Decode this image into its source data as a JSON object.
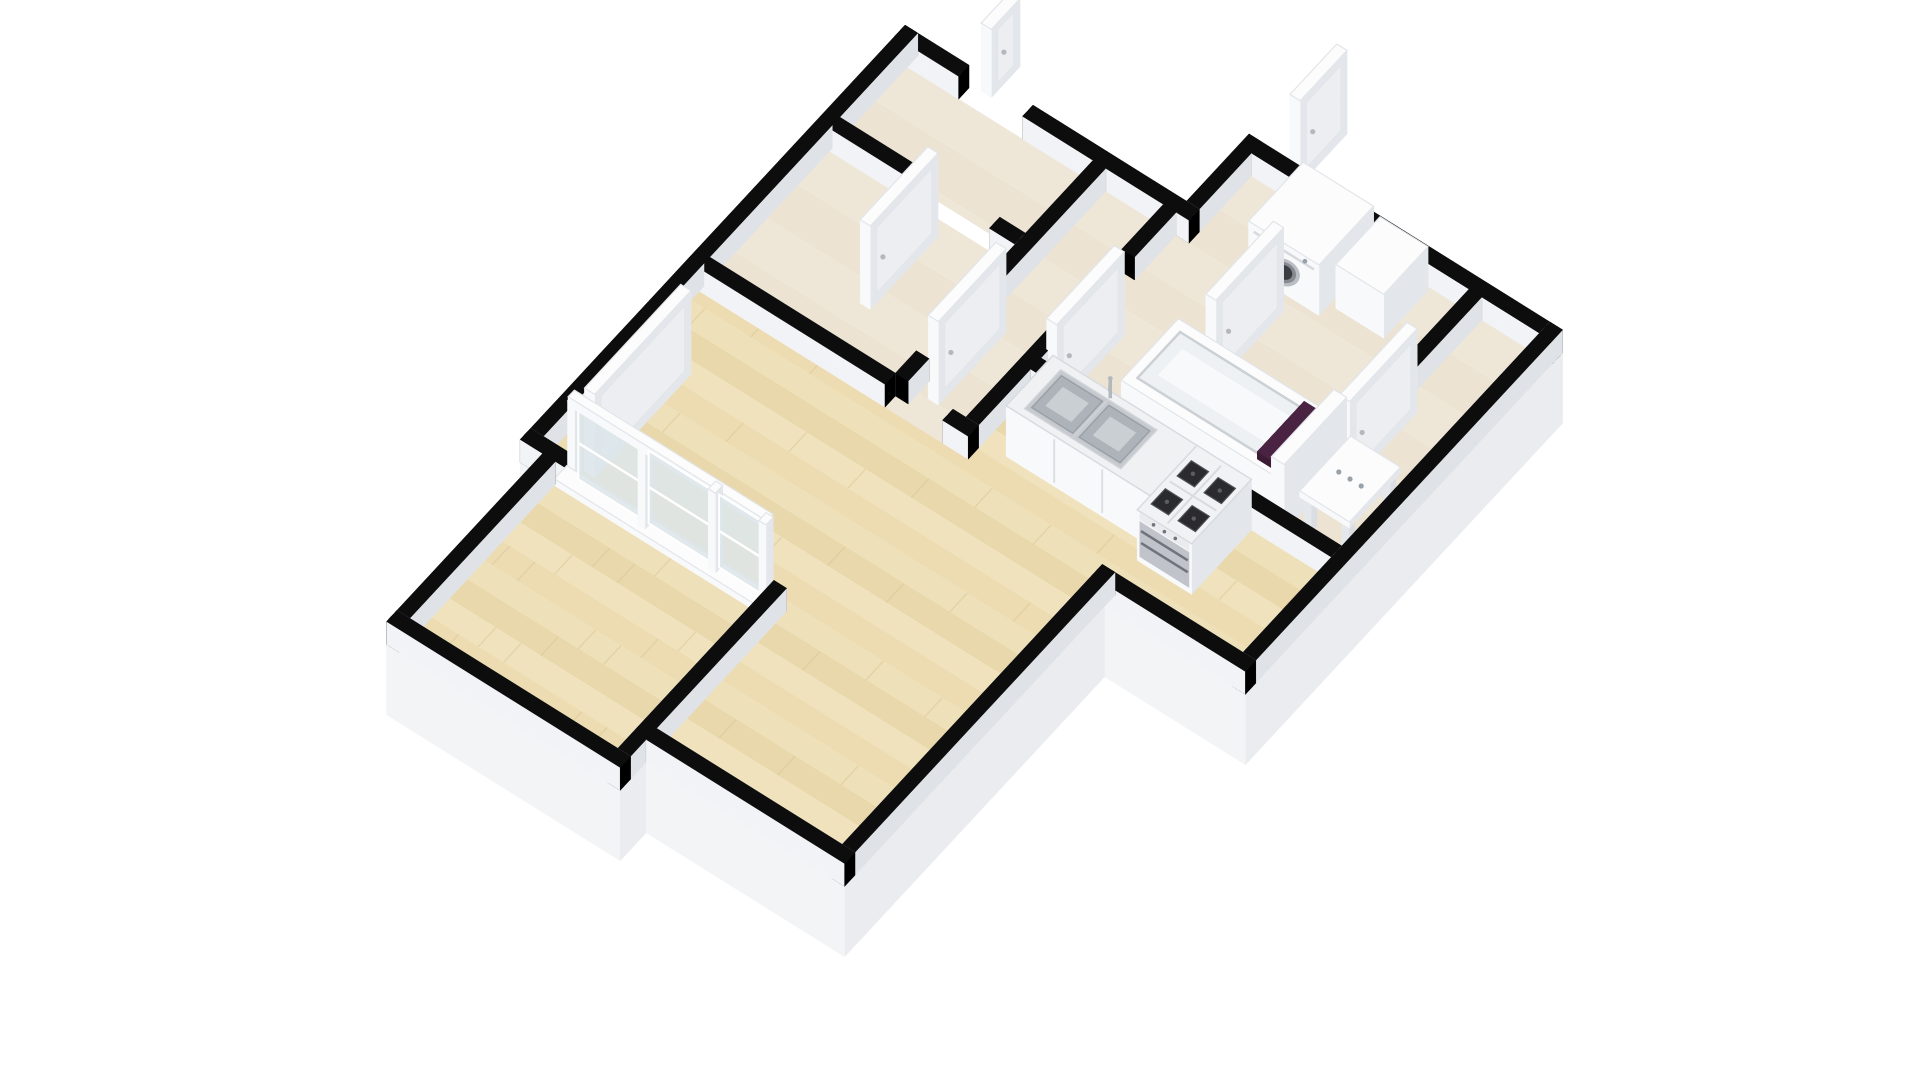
{
  "meta": {
    "description": "3D isometric floor plan rendering of a one-bedroom apartment: large living room with light parquet floor, open kitchen with double sink counter and gas stove, hallway with open white doors, bathroom with washing machine and bathtub with purple towel, separate toilet with washbasin console, and a long balcony room behind a glazed sliding-door wall",
    "canvas_width": 1920,
    "canvas_height": 1080,
    "background": "#ffffff"
  },
  "rooms": [
    {
      "name": "living-room",
      "floor": "parquet"
    },
    {
      "name": "kitchen",
      "floor": "parquet"
    },
    {
      "name": "hallway",
      "floor": "tile"
    },
    {
      "name": "entry",
      "floor": "tile"
    },
    {
      "name": "storage",
      "floor": "tile"
    },
    {
      "name": "bathroom",
      "floor": "tile"
    },
    {
      "name": "toilet",
      "floor": "tile"
    },
    {
      "name": "balcony",
      "floor": "parquet"
    }
  ],
  "projection": {
    "origin": [
      905,
      48
    ],
    "u": [
      640,
      400
    ],
    "v": [
      -520,
      560
    ],
    "z_scale": 440
  },
  "palette": {
    "background": "#ffffff",
    "wall_top": "#0d0d0d",
    "wall_cap": "#000000",
    "wall_side_sw": "#f2f3f6",
    "wall_side_ne": "#e6e9ed",
    "wall_side_se": "#dfe3e8",
    "wall_side_nw": "#edeff2",
    "slab_side_light": "#f3f4f6",
    "slab_side_dark": "#eaecef",
    "slab_top": "#ffffff",
    "wood_base": "#ecdbb0",
    "wood_bands": [
      "#f1e3bf",
      "#e8d5a7",
      "#f4e8c8",
      "#eedcb2"
    ],
    "wood_seam": "#d9c795",
    "tile_base": "#ece3d3",
    "tile_band": "#f3ecdf",
    "white_top": "#fcfcfd",
    "white_edge": "#e2e5e9",
    "white_py": "#f8f9fb",
    "white_ny": "#e7eaed",
    "white_px": "#e3e6ea",
    "white_nx": "#eef0f3",
    "glass": "#dce5ea",
    "steel": "#c0c4ca",
    "steel_dark": "#6f747c",
    "burner": "#2b2b2f",
    "burner_rim": "#4e5156",
    "grid_line": "#d9dbdf",
    "towel": "#4a2342",
    "towel_dark": "#3c1c35",
    "sink_rim": "#c6cacf",
    "sink_well": "#aeb3ba",
    "sink_inner": "#cdd1d6",
    "chrome": "#b3b8be",
    "washer_ring": "#b9bec5",
    "washer_mid": "#878b91",
    "washer_glass": "#3a3d42",
    "dot": "#9aa2a9"
  },
  "geometry": {
    "wall_height": 0.052,
    "slab_depth": 0.16,
    "slab_poly": [
      [
        0,
        0
      ],
      [
        0.44,
        0
      ],
      [
        0.44,
        -0.12
      ],
      [
        0.93,
        -0.12
      ],
      [
        0.93,
        0.49
      ],
      [
        0.71,
        0.49
      ],
      [
        0.71,
        0.99
      ],
      [
        0.4,
        0.99
      ],
      [
        0.4,
        1.04
      ],
      [
        0.035,
        1.04
      ],
      [
        0.035,
        0.74
      ],
      [
        0,
        0.74
      ]
    ],
    "floors": [
      {
        "name": "floor-living-kitchen",
        "type": "wood",
        "poly": [
          [
            0.02,
            0.42
          ],
          [
            0.44,
            0.42
          ],
          [
            0.44,
            0.3
          ],
          [
            0.91,
            0.3
          ],
          [
            0.91,
            0.47
          ],
          [
            0.69,
            0.47
          ],
          [
            0.69,
            0.97
          ],
          [
            0.4,
            0.97
          ],
          [
            0.4,
            0.72
          ],
          [
            0.02,
            0.72
          ]
        ]
      },
      {
        "name": "floor-balcony",
        "type": "wood",
        "poly": [
          [
            0.055,
            0.74
          ],
          [
            0.38,
            0.74
          ],
          [
            0.38,
            1.02
          ],
          [
            0.055,
            1.02
          ]
        ]
      },
      {
        "name": "floor-entry",
        "type": "tile",
        "poly": [
          [
            0.02,
            0.02
          ],
          [
            0.31,
            0.02
          ],
          [
            0.31,
            0.15
          ],
          [
            0.02,
            0.15
          ]
        ]
      },
      {
        "name": "floor-storage",
        "type": "tile",
        "poly": [
          [
            0.02,
            0.17
          ],
          [
            0.31,
            0.17
          ],
          [
            0.31,
            0.4
          ],
          [
            0.02,
            0.4
          ]
        ]
      },
      {
        "name": "floor-hallway",
        "type": "tile",
        "poly": [
          [
            0.31,
            0.02
          ],
          [
            0.44,
            0.02
          ],
          [
            0.44,
            0.42
          ],
          [
            0.31,
            0.42
          ]
        ]
      },
      {
        "name": "floor-bathroom",
        "type": "tile",
        "poly": [
          [
            0.44,
            -0.1
          ],
          [
            0.8,
            -0.1
          ],
          [
            0.8,
            0.3
          ],
          [
            0.44,
            0.3
          ]
        ]
      },
      {
        "name": "floor-toilet",
        "type": "tile",
        "poly": [
          [
            0.8,
            -0.1
          ],
          [
            0.91,
            -0.1
          ],
          [
            0.91,
            0.3
          ],
          [
            0.8,
            0.3
          ]
        ]
      }
    ],
    "plank_band": 0.034,
    "tile_band_step": 0.06,
    "walls": [
      {
        "name": "wall-outer-nw",
        "o": "v",
        "x": [
          0,
          0.02
        ],
        "y": [
          0,
          0.74
        ]
      },
      {
        "name": "wall-balcony-nw",
        "o": "v",
        "x": [
          0.035,
          0.055
        ],
        "y": [
          0.74,
          1.04
        ]
      },
      {
        "name": "wall-outer-ne-a",
        "o": "u",
        "x": [
          0,
          0.1
        ],
        "y": [
          0,
          0.02
        ]
      },
      {
        "name": "wall-outer-ne-b",
        "o": "u",
        "x": [
          0.2,
          0.46
        ],
        "y": [
          0,
          0.02
        ]
      },
      {
        "name": "wall-wing-step",
        "o": "v",
        "x": [
          0.44,
          0.46
        ],
        "y": [
          -0.12,
          0.02
        ]
      },
      {
        "name": "wall-wing-ne-a",
        "o": "u",
        "x": [
          0.46,
          0.52
        ],
        "y": [
          -0.12,
          -0.1
        ]
      },
      {
        "name": "wall-wing-ne-b",
        "o": "u",
        "x": [
          0.62,
          0.93
        ],
        "y": [
          -0.12,
          -0.1
        ]
      },
      {
        "name": "wall-outer-e",
        "o": "v",
        "x": [
          0.91,
          0.93
        ],
        "y": [
          -0.12,
          0.49
        ]
      },
      {
        "name": "wall-kitchen-se",
        "o": "u",
        "x": [
          0.69,
          0.93
        ],
        "y": [
          0.47,
          0.49
        ]
      },
      {
        "name": "wall-living-se",
        "o": "v",
        "x": [
          0.69,
          0.71
        ],
        "y": [
          0.47,
          0.99
        ]
      },
      {
        "name": "wall-living-sw",
        "o": "u",
        "x": [
          0.4,
          0.71
        ],
        "y": [
          0.97,
          0.99
        ]
      },
      {
        "name": "wall-balcony-se",
        "o": "v",
        "x": [
          0.38,
          0.4
        ],
        "y": [
          0.72,
          1.04
        ]
      },
      {
        "name": "wall-balcony-sw",
        "o": "u",
        "x": [
          0.035,
          0.4
        ],
        "y": [
          1.02,
          1.04
        ]
      },
      {
        "name": "wall-window-stub",
        "o": "u",
        "x": [
          0,
          0.07
        ],
        "y": [
          0.72,
          0.74
        ]
      },
      {
        "name": "wall-strips-div-a",
        "o": "u",
        "x": [
          0.02,
          0.17
        ],
        "y": [
          0.15,
          0.17
        ]
      },
      {
        "name": "wall-strips-div-b",
        "o": "u",
        "x": [
          0.27,
          0.31
        ],
        "y": [
          0.15,
          0.17
        ]
      },
      {
        "name": "wall-strips-hall-a",
        "o": "v",
        "x": [
          0.31,
          0.33
        ],
        "y": [
          0.02,
          0.26
        ]
      },
      {
        "name": "wall-strips-hall-b",
        "o": "v",
        "x": [
          0.31,
          0.33
        ],
        "y": [
          0.36,
          0.4
        ]
      },
      {
        "name": "wall-living-ne",
        "o": "u",
        "x": [
          0.02,
          0.31
        ],
        "y": [
          0.4,
          0.42
        ]
      },
      {
        "name": "wall-living-ne-stub",
        "o": "u",
        "x": [
          0.4,
          0.44
        ],
        "y": [
          0.4,
          0.42
        ]
      },
      {
        "name": "wall-hall-bath-a",
        "o": "v",
        "x": [
          0.42,
          0.44
        ],
        "y": [
          0.02,
          0.1
        ]
      },
      {
        "name": "wall-hall-bath-b",
        "o": "v",
        "x": [
          0.42,
          0.44
        ],
        "y": [
          0.2,
          0.4
        ]
      },
      {
        "name": "wall-bath-kitchen",
        "o": "u",
        "x": [
          0.44,
          0.91
        ],
        "y": [
          0.28,
          0.3
        ]
      },
      {
        "name": "wall-bath-toilet",
        "o": "v",
        "x": [
          0.8,
          0.82
        ],
        "y": [
          -0.1,
          0.06
        ]
      }
    ],
    "doors": [
      {
        "name": "entry-door",
        "x": [
          0.115,
          0.131
        ],
        "y": [
          -0.06,
          -0.005
        ],
        "h": 0.155
      },
      {
        "name": "utility-door",
        "x": [
          0.5,
          0.516
        ],
        "y": [
          -0.215,
          -0.125
        ],
        "h": 0.19
      },
      {
        "name": "hall-living-door",
        "x": [
          0.345,
          0.361
        ],
        "y": [
          0.25,
          0.38
        ],
        "h": 0.19
      },
      {
        "name": "bathroom-door",
        "x": [
          0.465,
          0.481
        ],
        "y": [
          0.17,
          0.3
        ],
        "h": 0.19
      },
      {
        "name": "bathroom-inner-door",
        "x": [
          0.6,
          0.616
        ],
        "y": [
          0.03,
          0.16
        ],
        "h": 0.19
      },
      {
        "name": "toilet-door",
        "x": [
          0.825,
          0.841
        ],
        "y": [
          0.05,
          0.18
        ],
        "h": 0.19
      },
      {
        "name": "storage-door",
        "x": [
          0.19,
          0.206
        ],
        "y": [
          0.19,
          0.32
        ],
        "h": 0.19
      },
      {
        "name": "balcony-door",
        "x": [
          0.072,
          0.088
        ],
        "y": [
          0.52,
          0.705
        ],
        "h": 0.19
      }
    ],
    "window_assembly": {
      "name": "balcony-glazing",
      "sill": {
        "x": [
          0.055,
          0.39
        ],
        "y": [
          0.718,
          0.742
        ],
        "h": 0.015
      },
      "frame_y": 0.728,
      "glass_z": [
        0.02,
        0.185
      ],
      "posts_x": [
        0.07,
        0.18,
        0.29,
        0.369
      ],
      "post_w": 0.011,
      "rail": {
        "x": [
          0.07,
          0.38
        ],
        "y": [
          0.722,
          0.734
        ],
        "z": [
          0.185,
          0.205
        ]
      }
    },
    "furniture": [
      {
        "type": "washer",
        "name": "washing-machine",
        "x": [
          0.545,
          0.655
        ],
        "y": [
          -0.095,
          0.01
        ],
        "h": 0.115
      },
      {
        "type": "box",
        "name": "bathroom-cabinet",
        "x": [
          0.665,
          0.74
        ],
        "y": [
          -0.095,
          -0.01
        ],
        "h": 0.1
      },
      {
        "type": "tub",
        "name": "bathtub",
        "x": [
          0.545,
          0.79
        ],
        "y": [
          0.145,
          0.255
        ],
        "h": 0.065
      },
      {
        "type": "towel",
        "name": "bath-towel",
        "x": [
          0.752,
          0.782
        ],
        "y": [
          0.158,
          0.248
        ],
        "z": [
          0.065,
          0.082
        ]
      },
      {
        "type": "partition",
        "name": "toilet-partition",
        "x": [
          0.8,
          0.82
        ],
        "y": [
          0.16,
          0.28
        ],
        "h": 0.155
      },
      {
        "type": "console",
        "name": "washbasin-console",
        "x": [
          0.835,
          0.905
        ],
        "y": [
          0.17,
          0.26
        ],
        "h": 0.085
      },
      {
        "type": "counter",
        "name": "kitchen-counter",
        "x": [
          0.475,
          0.7
        ],
        "y": [
          0.3,
          0.39
        ],
        "h": 0.115
      },
      {
        "type": "stove",
        "name": "gas-stove",
        "x": [
          0.7,
          0.785
        ],
        "y": [
          0.3,
          0.415
        ],
        "h": 0.115
      }
    ]
  }
}
